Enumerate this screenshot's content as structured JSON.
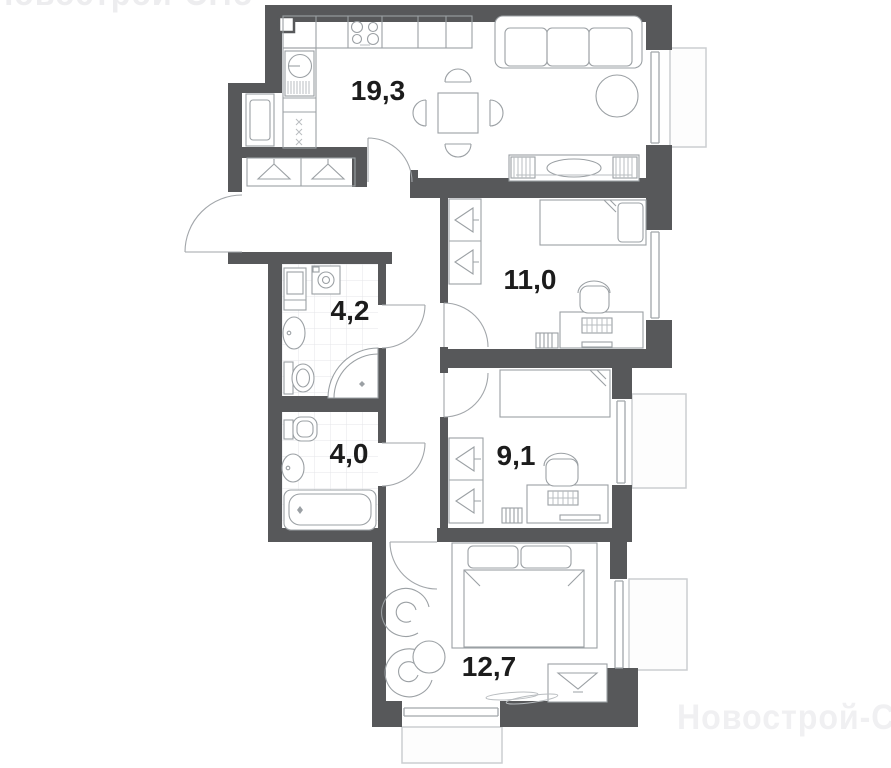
{
  "plan": {
    "watermark": "Новострой-СПб",
    "rooms": [
      {
        "id": "kitchen-living",
        "area": "19,3"
      },
      {
        "id": "bedroom",
        "area": "11,0"
      },
      {
        "id": "bathroom",
        "area": "4,2"
      },
      {
        "id": "bath-wc",
        "area": "4,0"
      },
      {
        "id": "room-9",
        "area": "9,1"
      },
      {
        "id": "room-12",
        "area": "12,7"
      }
    ],
    "colors": {
      "wall": "#57585a",
      "furniture_stroke": "#9ba0a4",
      "window_stroke": "#a2a6aa",
      "balcony_stroke": "#cbced1",
      "tile_grid": "#e4e6e8",
      "label_text": "#1c1c1c",
      "watermark": "#f0f0f2",
      "background": "#ffffff"
    }
  }
}
